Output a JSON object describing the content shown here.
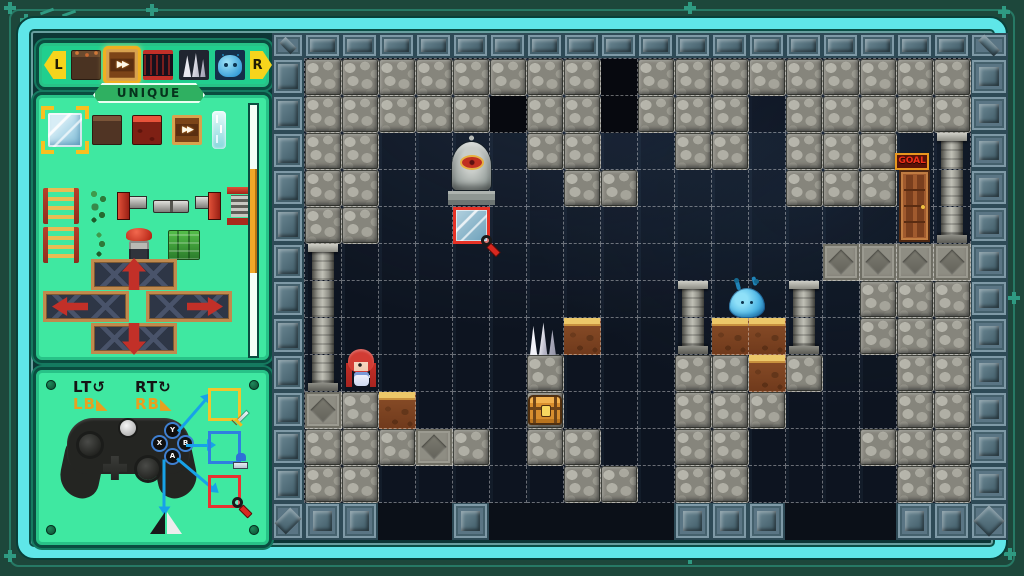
{
  "sidebar": {
    "tabs": {
      "left_label": "L",
      "right_label": "R",
      "items": [
        {
          "name": "dirt",
          "selected": false
        },
        {
          "name": "conveyor",
          "selected": true
        },
        {
          "name": "trap",
          "selected": false
        },
        {
          "name": "crystal",
          "selected": false
        },
        {
          "name": "slime",
          "selected": false
        }
      ]
    },
    "group_label": "UNIQUE",
    "palette": {
      "row1": [
        {
          "name": "ice",
          "selected": true
        },
        {
          "name": "brown",
          "selected": false
        },
        {
          "name": "lava",
          "selected": false
        },
        {
          "name": "conveyor",
          "selected": false
        },
        {
          "name": "fall",
          "selected": false
        }
      ],
      "row2": [
        {
          "name": "ladder"
        },
        {
          "name": "vine"
        },
        {
          "name": "pipeL"
        },
        {
          "name": "pipeM"
        },
        {
          "name": "pipeJ"
        },
        {
          "name": "spring"
        }
      ],
      "row3": [
        {
          "name": "ladder"
        },
        {
          "name": "vinesm"
        },
        {
          "name": "plunger"
        },
        {
          "name": "moss"
        }
      ],
      "platforms": [
        {
          "dir": "up"
        },
        {
          "dir": "left"
        },
        {
          "dir": "right"
        },
        {
          "dir": "down"
        }
      ]
    },
    "controller": {
      "lt": "LT",
      "lt_glyph": "↺",
      "rt": "RT",
      "rt_glyph": "↻",
      "lb": "LB",
      "lb_glyph": "◣",
      "rb": "RB",
      "rb_glyph": "◣",
      "buttons": {
        "y": "Y",
        "x": "X",
        "b": "B",
        "a": "A"
      },
      "bindings": [
        {
          "button": "Y",
          "tool": "sword",
          "color": "#f2c52c"
        },
        {
          "button": "B",
          "tool": "stamp",
          "color": "#2f80e0"
        },
        {
          "button": "A",
          "tool": "magnifier",
          "color": "#e83232"
        },
        {
          "button": "X",
          "tool": "flip-horizontal",
          "color": ""
        }
      ]
    }
  },
  "editor": {
    "goal_label": "GOAL",
    "grid": {
      "cols": 18,
      "rows": 12,
      "cell": 37
    },
    "legend": {
      "C": "cobblestone",
      "c": "cobblestone-dark",
      "x": "void-dark",
      "D": "carved-stone",
      "d": "dirt",
      "P": "pillar",
      ".": "empty"
    },
    "tilemap": [
      "CCCCCCCCxCCCCCCCCC",
      "CCCCCxCCxCCCcCCCCC",
      "CC....CC..CC.CCC.P",
      "CC.....CC....CCC.P",
      "CC...............P",
      "P.............DDDD",
      "P.........P..P.CCC",
      "P......d..PddP.CCC",
      "P.....C...CCdC..CC",
      "DCd...C...CCC...CC",
      "CCCDC.CC..CC...CCC",
      "CC.....CC.CC....CC"
    ],
    "bottom_border_blocks": [
      0,
      1,
      4,
      10,
      11,
      12,
      16,
      17
    ],
    "sprites": [
      {
        "type": "statue",
        "name": "stone-statue",
        "col": 3.87,
        "row": 2.05,
        "w": 47,
        "h": 70
      },
      {
        "type": "goal",
        "name": "goal-sign",
        "col": 15.95,
        "row": 2.55,
        "w": 34,
        "h": 17
      },
      {
        "type": "door",
        "name": "goal-door",
        "col": 16.05,
        "row": 3.0,
        "w": 31,
        "h": 72
      },
      {
        "type": "crystals",
        "name": "crystal-spikes",
        "col": 6.05,
        "row": 7.12,
        "w": 28,
        "h": 33
      },
      {
        "type": "chest",
        "name": "treasure-chest",
        "col": 6.02,
        "row": 9.08,
        "w": 34,
        "h": 30
      },
      {
        "type": "slime",
        "name": "slime-enemy",
        "col": 11.45,
        "row": 6.18,
        "w": 36,
        "h": 30
      },
      {
        "type": "girl",
        "name": "player-character",
        "col": 1.1,
        "row": 7.85,
        "w": 30,
        "h": 43
      },
      {
        "type": "icesel",
        "name": "selected-tile-highlight",
        "col": 4,
        "row": 4,
        "w": 37,
        "h": 37
      },
      {
        "type": "cursor",
        "name": "magnifier-cursor-icon",
        "col": 4.75,
        "row": 4.75,
        "w": 20,
        "h": 20
      }
    ],
    "selection": {
      "col": 4,
      "row": 4,
      "tile": "ice"
    },
    "cursor": {
      "tool": "magnifier",
      "col": 4.75,
      "row": 4.75
    }
  },
  "colors": {
    "frame_cyan": "#5fe6e8",
    "panel_mint": "#3fe8a1",
    "panel_border": "#0a4d40",
    "accent_yellow": "#f6d41c",
    "select_red": "#e63226",
    "arrow_blue": "#17a2e8",
    "goal_red": "#f23018",
    "unique_green": "#2fb061"
  }
}
